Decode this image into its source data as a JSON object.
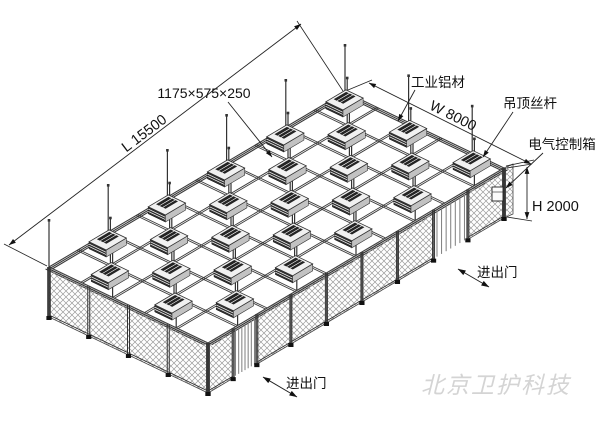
{
  "labels": {
    "ffu_size": "1175×575×250",
    "industrial_aluminum": "工业铝材",
    "width_dim": "W 8000",
    "ceiling_rod": "吊顶丝杆",
    "electrical_box": "电气控制箱",
    "length_dim": "L 15500",
    "height_dim": "H 2000",
    "door_front": "进出门",
    "door_side": "进出门"
  },
  "watermark": "北京卫护科技",
  "colors": {
    "line": "#222222",
    "mesh": "#9a9a9a",
    "ffu_dark": "#2e2e2e",
    "watermark": "#d4d4d4",
    "background": "#ffffff"
  }
}
